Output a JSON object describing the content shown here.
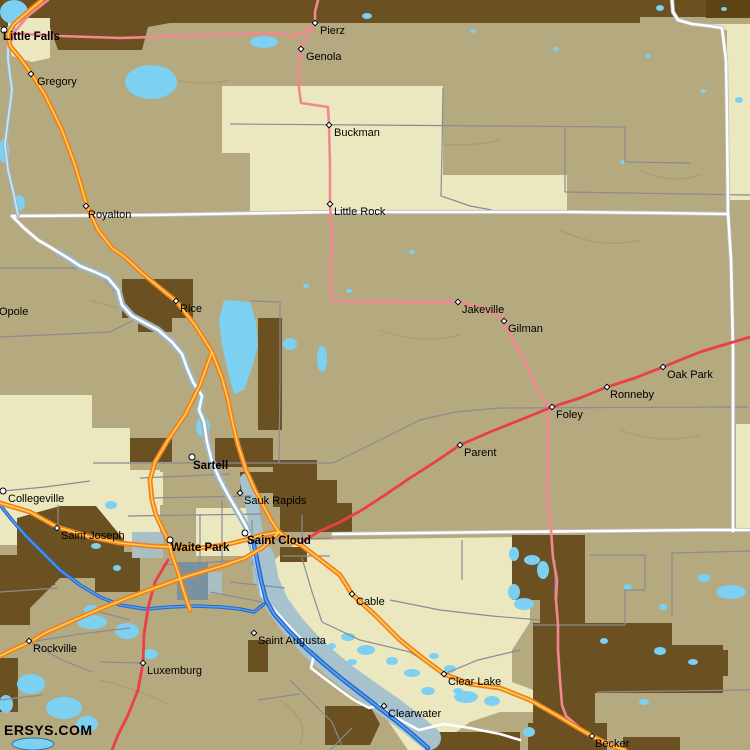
{
  "map": {
    "watermark": "ERSYS.COM",
    "region_hint": "Saint Cloud / Little Falls area map",
    "palette": {
      "land_tan": "#b5a980",
      "land_cream": "#ebe8c0",
      "urban_brown": "#6b5021",
      "dark_brown_band": "#5e4414",
      "lake_blue": "#7cd0f2",
      "river_dark": "#2268cf",
      "river_mid": "#5aa0e8",
      "river_pale": "#9cb6c6",
      "floodplain": "#a6c3cd",
      "quarry_teal": "#78939f",
      "quarry_pale": "#a9bfc6",
      "road_orange": "#f07f23",
      "road_yellow_center": "#ffd24a",
      "road_red": "#ec3e46",
      "road_pink": "#f2878f",
      "county_line_white": "#ffffff",
      "road_gray": "#8b8a96",
      "label_color": "#000000"
    },
    "cities": [
      {
        "name": "Little Falls",
        "bold": true,
        "marker": "circle",
        "mx": 4,
        "my": 30,
        "lx": 3,
        "ly": 32
      },
      {
        "name": "Gregory",
        "bold": false,
        "marker": "diamond",
        "mx": 31,
        "my": 74,
        "lx": 37,
        "ly": 77
      },
      {
        "name": "Pierz",
        "bold": false,
        "marker": "diamond",
        "mx": 315,
        "my": 23,
        "lx": 320,
        "ly": 26
      },
      {
        "name": "Genola",
        "bold": false,
        "marker": "diamond",
        "mx": 301,
        "my": 49,
        "lx": 306,
        "ly": 52
      },
      {
        "name": "Buckman",
        "bold": false,
        "marker": "diamond",
        "mx": 329,
        "my": 125,
        "lx": 334,
        "ly": 128
      },
      {
        "name": "Royalton",
        "bold": false,
        "marker": "diamond",
        "mx": 86,
        "my": 206,
        "lx": 88,
        "ly": 210
      },
      {
        "name": "Little Rock",
        "bold": false,
        "marker": "diamond",
        "mx": 330,
        "my": 204,
        "lx": 334,
        "ly": 207
      },
      {
        "name": "Opole",
        "bold": false,
        "marker": "none",
        "mx": 0,
        "my": 0,
        "lx": -1,
        "ly": 307
      },
      {
        "name": "Rice",
        "bold": false,
        "marker": "diamond",
        "mx": 176,
        "my": 301,
        "lx": 180,
        "ly": 304
      },
      {
        "name": "Jakeville",
        "bold": false,
        "marker": "diamond",
        "mx": 458,
        "my": 302,
        "lx": 462,
        "ly": 305
      },
      {
        "name": "Gilman",
        "bold": false,
        "marker": "diamond",
        "mx": 504,
        "my": 321,
        "lx": 508,
        "ly": 324
      },
      {
        "name": "Oak Park",
        "bold": false,
        "marker": "diamond",
        "mx": 663,
        "my": 367,
        "lx": 667,
        "ly": 370
      },
      {
        "name": "Ronneby",
        "bold": false,
        "marker": "diamond",
        "mx": 607,
        "my": 387,
        "lx": 610,
        "ly": 390
      },
      {
        "name": "Foley",
        "bold": false,
        "marker": "diamond",
        "mx": 552,
        "my": 407,
        "lx": 556,
        "ly": 410
      },
      {
        "name": "Parent",
        "bold": false,
        "marker": "diamond",
        "mx": 460,
        "my": 445,
        "lx": 464,
        "ly": 448
      },
      {
        "name": "Sartell",
        "bold": true,
        "marker": "circle",
        "mx": 192,
        "my": 457,
        "lx": 193,
        "ly": 461
      },
      {
        "name": "Collegeville",
        "bold": false,
        "marker": "circle",
        "mx": 3,
        "my": 491,
        "lx": 8,
        "ly": 494
      },
      {
        "name": "Sauk Rapids",
        "bold": false,
        "marker": "diamond",
        "mx": 240,
        "my": 493,
        "lx": 244,
        "ly": 496
      },
      {
        "name": "Saint Joseph",
        "bold": false,
        "marker": "diamond",
        "mx": 57,
        "my": 528,
        "lx": 61,
        "ly": 531
      },
      {
        "name": "Waite Park",
        "bold": true,
        "marker": "circle",
        "mx": 170,
        "my": 540,
        "lx": 171,
        "ly": 543
      },
      {
        "name": "Saint Cloud",
        "bold": true,
        "marker": "circle",
        "mx": 245,
        "my": 533,
        "lx": 247,
        "ly": 536
      },
      {
        "name": "Cable",
        "bold": false,
        "marker": "diamond",
        "mx": 352,
        "my": 594,
        "lx": 356,
        "ly": 597
      },
      {
        "name": "Rockville",
        "bold": false,
        "marker": "diamond",
        "mx": 29,
        "my": 641,
        "lx": 33,
        "ly": 644
      },
      {
        "name": "Saint Augusta",
        "bold": false,
        "marker": "diamond",
        "mx": 254,
        "my": 633,
        "lx": 258,
        "ly": 636
      },
      {
        "name": "Luxemburg",
        "bold": false,
        "marker": "diamond",
        "mx": 143,
        "my": 663,
        "lx": 147,
        "ly": 666
      },
      {
        "name": "Clear Lake",
        "bold": false,
        "marker": "diamond",
        "mx": 444,
        "my": 674,
        "lx": 448,
        "ly": 677
      },
      {
        "name": "Clearwater",
        "bold": false,
        "marker": "diamond",
        "mx": 384,
        "my": 706,
        "lx": 388,
        "ly": 709
      },
      {
        "name": "Becker",
        "bold": false,
        "marker": "diamond",
        "mx": 592,
        "my": 736,
        "lx": 595,
        "ly": 739
      }
    ]
  }
}
